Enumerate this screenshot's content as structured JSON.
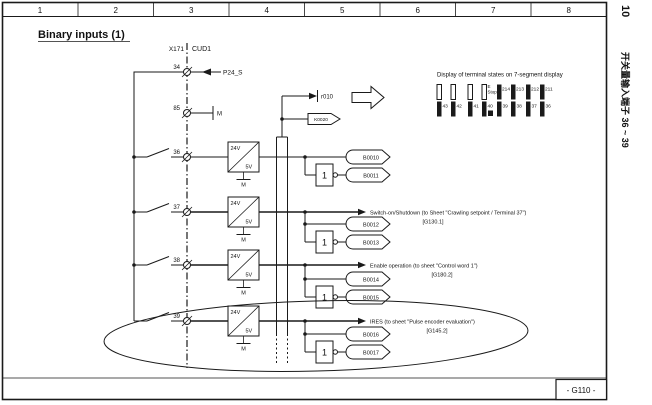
{
  "page": {
    "title": "Binary inputs (1)",
    "ruler": [
      "1",
      "2",
      "3",
      "4",
      "5",
      "6",
      "7",
      "8"
    ],
    "page_number": "10",
    "side_caption": "开关量输入端子 36 ~ 39",
    "sheet_ref": "- G110 -"
  },
  "connector": {
    "name": "X171",
    "board": "CUD1"
  },
  "power": {
    "terminal_top": "34",
    "p24": "P24_S",
    "terminal_gnd": "85",
    "m": "M"
  },
  "converter": {
    "input": "24V",
    "output": "5V",
    "ground": "M"
  },
  "logic": {
    "inverter": "1"
  },
  "display": {
    "caption": "Display of terminal states on 7-segment display",
    "r010": "r010",
    "k0020": "K0020",
    "digits": [
      {
        "bottom": [
          "43",
          "42"
        ]
      },
      {
        "note1": "E",
        "note2": "Stop",
        "bottom": [
          "41",
          "40"
        ]
      },
      {
        "top": [
          "214",
          "213"
        ],
        "bottom": [
          "39",
          "38"
        ]
      },
      {
        "top": [
          "212",
          "211"
        ],
        "bottom": [
          "37",
          "36"
        ]
      }
    ]
  },
  "channels": [
    {
      "terminal": "36",
      "direct": "B0010",
      "inverted": "B0011",
      "annotation": "",
      "ref": ""
    },
    {
      "terminal": "37",
      "direct": "B0012",
      "inverted": "B0013",
      "annotation": "Switch-on/Shutdown (to Sheet \"Crawling setpoint / Terminal 37\")",
      "ref": "[G130.1]"
    },
    {
      "terminal": "38",
      "direct": "B0014",
      "inverted": "B0015",
      "annotation": "Enable operation (to sheet \"Control word 1\")",
      "ref": "[G180.2]"
    },
    {
      "terminal": "39",
      "direct": "B0016",
      "inverted": "B0017",
      "annotation": "IRES (to sheet \"Pulse encoder evaluation\")",
      "ref": "[G145.2]"
    }
  ]
}
